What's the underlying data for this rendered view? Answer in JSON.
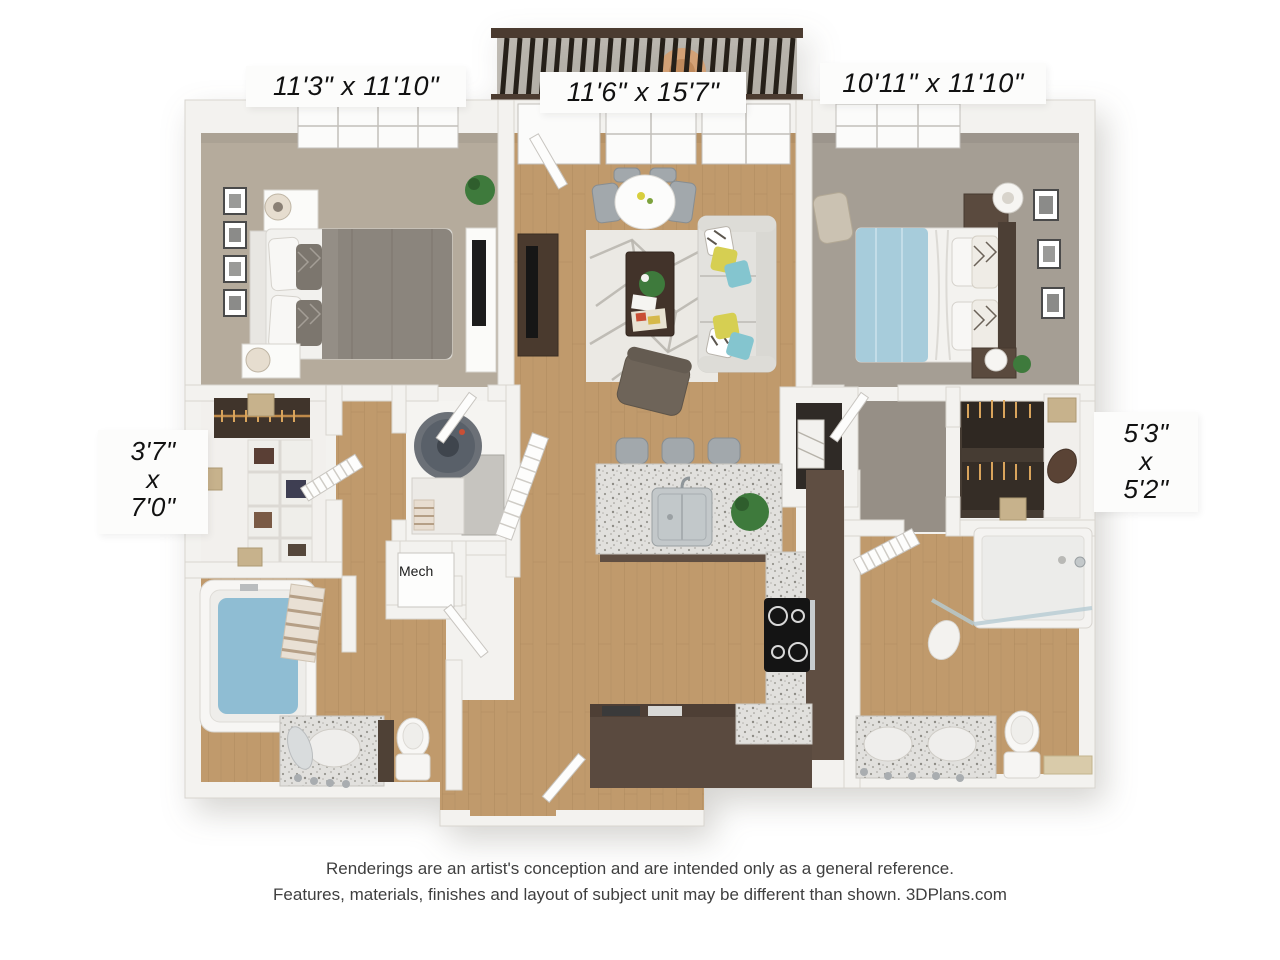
{
  "rooms": {
    "bedroom1": {
      "dimensions": "11'3\" x 11'10\""
    },
    "living": {
      "dimensions": "11'6\" x 15'7\""
    },
    "bedroom2": {
      "dimensions": "10'11\" x 11'10\""
    },
    "closet1": {
      "width": "3'7\"",
      "separator": "x",
      "depth": "7'0\""
    },
    "closet2": {
      "width": "5'3\"",
      "separator": "x",
      "depth": "5'2\""
    },
    "mech": {
      "label": "Mech"
    }
  },
  "disclaimer": {
    "line1": "Renderings are an artist's conception and are intended only as a general reference.",
    "line2": "Features, materials, finishes and layout of subject unit may be different than shown. 3DPlans.com"
  },
  "colors": {
    "page-bg": "#ffffff",
    "wall": "#f3f2ef",
    "wall-edge": "#d8d5cf",
    "wood-floor": "#c09a6c",
    "wood-plank": "#a9855a",
    "carpet-1": "#b5ab9c",
    "carpet-2": "#a59e94",
    "carpet-hall": "#968f86",
    "rug": "#ebe9e4",
    "rug-pattern": "#b7b4ad",
    "sofa": "#e3e2de",
    "duvet-gray": "#8b857d",
    "throw-blue": "#a7ccdb",
    "headboard-dark": "#4c3f35",
    "cabinet-brown": "#5f4e42",
    "granite": "#e1e0dd",
    "railing-dark": "#262019",
    "railing-frame": "#4b3b30",
    "plant-green": "#3e7a3c",
    "water-blue": "#8fbdd3",
    "pillow-yellow": "#d6cf52",
    "pillow-teal": "#84c5cf",
    "steel": "#c3c8ca",
    "chair-gray": "#a2a8ac",
    "armchair": "#6e6459",
    "box-tan": "#c7b28c",
    "label-text": "#111111",
    "disclaimer-text": "#3f3f3f"
  }
}
